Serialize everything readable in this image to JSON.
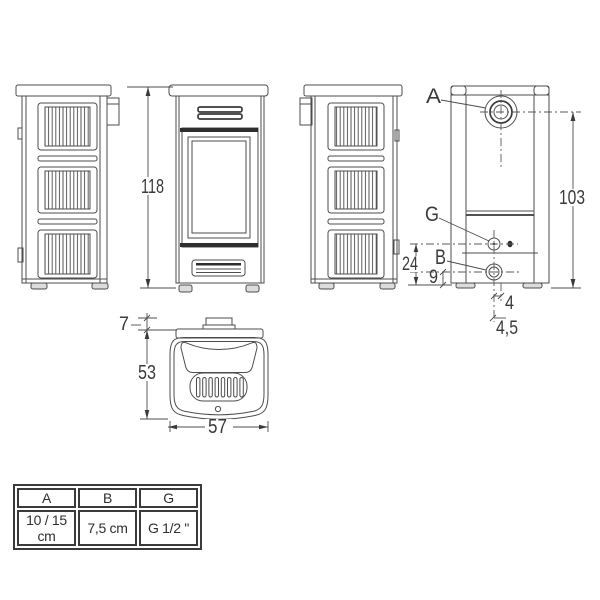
{
  "drawing": {
    "dims": {
      "front_height": "118",
      "rear_height": "103",
      "g_from_floor": "24",
      "b_from_floor": "9",
      "offset": "4",
      "offset_alt": "4,5",
      "collar": "7",
      "depth": "53",
      "width": "57"
    },
    "labels": {
      "flue": "A",
      "fitting_g": "G",
      "fitting_b": "B"
    }
  },
  "table": {
    "headers": [
      "A",
      "B",
      "G"
    ],
    "values": [
      "10 / 15 cm",
      "7,5 cm",
      "G 1/2 \""
    ]
  },
  "colors": {
    "line": "#4d4d4d",
    "dark": "#2e2e2e",
    "text": "#3a3a3a",
    "background": "#ffffff"
  }
}
